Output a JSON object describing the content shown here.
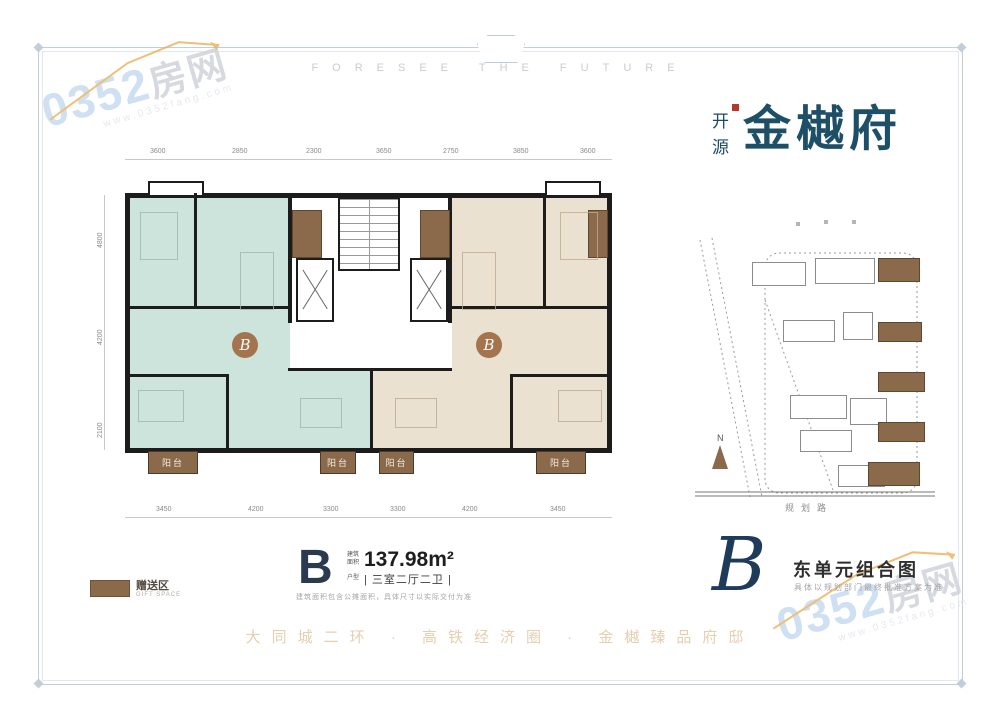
{
  "header": {
    "tagline_en": "FORESEE THE FUTURE"
  },
  "brand": {
    "prefix_chars": [
      "开",
      "源"
    ],
    "name": "金樾府"
  },
  "watermark": {
    "number": "0352",
    "suffix": "房网",
    "url": "www.0352fang.com"
  },
  "floor_plan": {
    "unit_badge": "B",
    "balcony_label": "阳台",
    "dims_top": [
      "3600",
      "2850",
      "2300",
      "3650",
      "2750",
      "3850",
      "3600"
    ],
    "dims_bottom": [
      "3450",
      "4200",
      "3300",
      "3300",
      "4200",
      "3450"
    ],
    "dims_left": [
      "4800",
      "4200",
      "2100"
    ]
  },
  "legend": {
    "label": "赠送区",
    "caption": "GIFT SPACE"
  },
  "unit_info": {
    "letter": "B",
    "area_label": "建筑面积",
    "area_value": "137.98m²",
    "layout_label": "户型",
    "layout_value": "| 三室二厅二卫 |",
    "note": "建筑面积包含公摊面积，具体尺寸以实际交付为准"
  },
  "section_title": {
    "letter": "B",
    "title": "东单元组合图",
    "subtitle": "具体以规划部门最终批准方案为准"
  },
  "site_plan": {
    "road_label": "规划路",
    "compass_label": "N"
  },
  "tagline_cn": "大同城二环 · 高铁经济圈 · 金樾臻品府邸"
}
